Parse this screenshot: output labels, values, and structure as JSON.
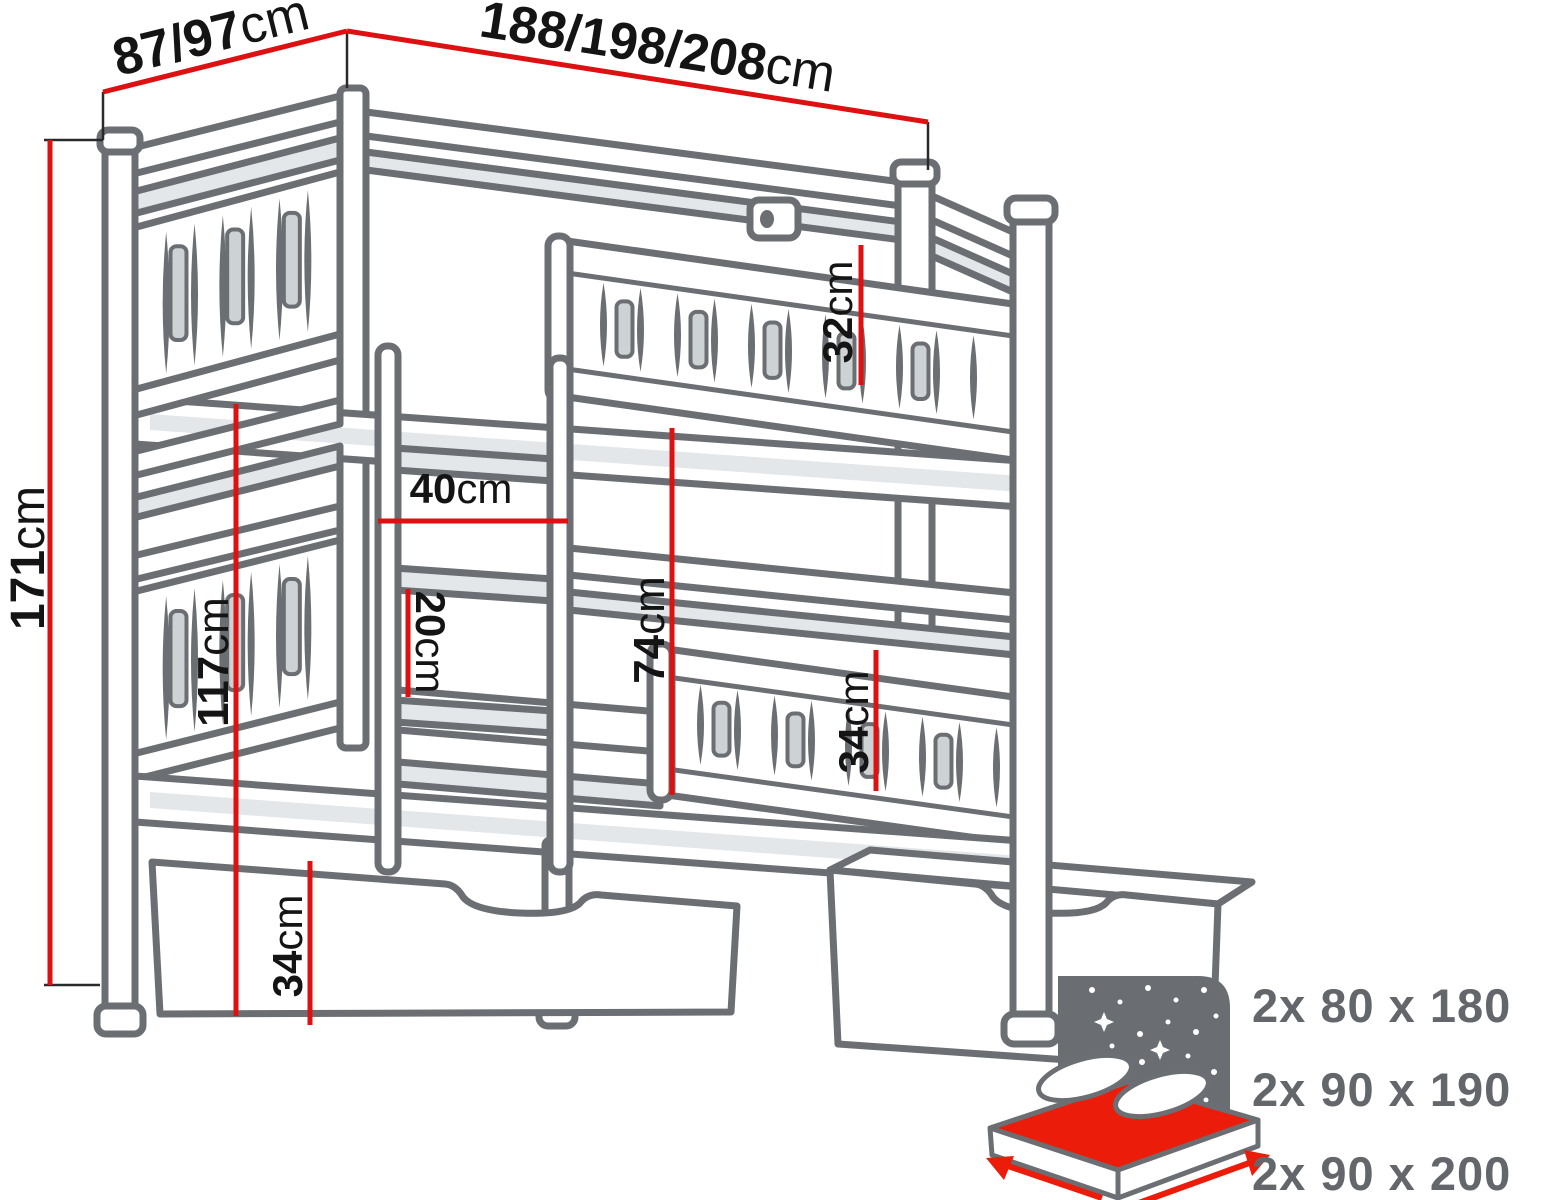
{
  "diagram": {
    "subject": "bunk-bed-with-drawers-dimension-diagram"
  },
  "dimensions": {
    "total_height": {
      "value": "171",
      "unit": "cm"
    },
    "depth": {
      "value": "87/97",
      "unit": "cm"
    },
    "length": {
      "value": "188/198/208",
      "unit": "cm"
    },
    "upper_guard_rail": {
      "value": "32",
      "unit": "cm"
    },
    "ladder_width": {
      "value": "40",
      "unit": "cm"
    },
    "ladder_rung_gap": {
      "value": "20",
      "unit": "cm"
    },
    "bunk_clearance": {
      "value": "74",
      "unit": "cm"
    },
    "lower_post_height": {
      "value": "117",
      "unit": "cm"
    },
    "drawer_height": {
      "value": "34",
      "unit": "cm"
    },
    "lower_guard_rail": {
      "value": "34",
      "unit": "cm"
    }
  },
  "mattress_sizes": [
    "2x 80 x 180",
    "2x 90 x 190",
    "2x 90 x 200"
  ],
  "colors": {
    "dimension_red": "#dd1111",
    "line_gray": "#6b6f73",
    "panel_light": "#e3e7e9",
    "label_black": "#141414",
    "mattress_red": "#ec1c0a",
    "info_text_gray": "#63676b"
  }
}
